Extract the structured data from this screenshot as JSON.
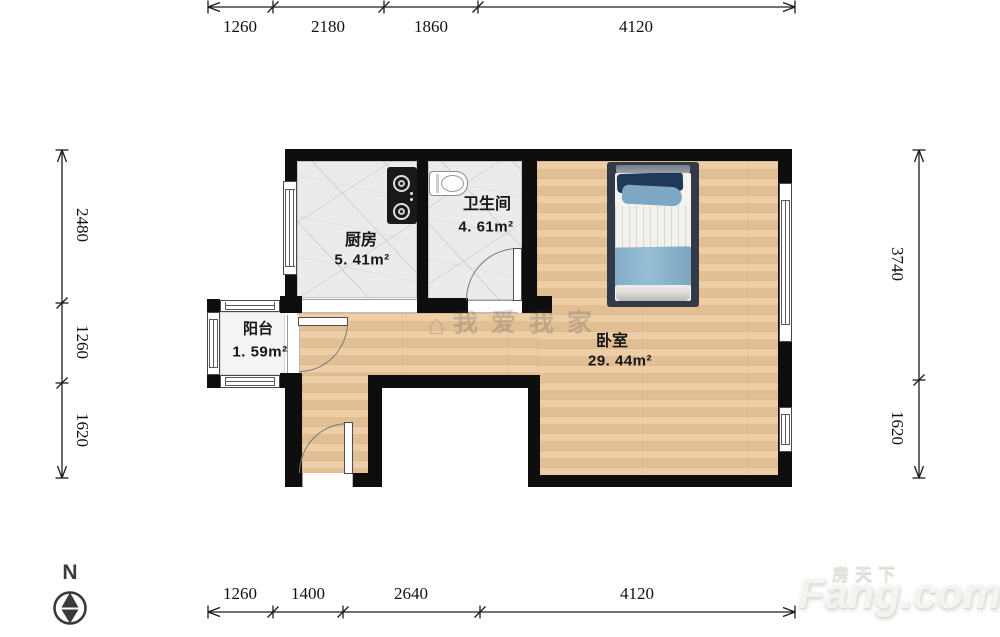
{
  "rooms": {
    "kitchen": {
      "name": "厨房",
      "area": "5. 41m²"
    },
    "bathroom": {
      "name": "卫生间",
      "area": "4. 61m²"
    },
    "balcony": {
      "name": "阳台",
      "area": "1. 59m²"
    },
    "bedroom": {
      "name": "卧室",
      "area": "29. 44m²"
    }
  },
  "dimensions": {
    "top": [
      "1260",
      "2180",
      "1860",
      "4120"
    ],
    "bottom": [
      "1260",
      "1400",
      "2640",
      "4120"
    ],
    "left": [
      "2480",
      "1260",
      "1620"
    ],
    "right": [
      "3740",
      "1620"
    ]
  },
  "compass": {
    "label": "N"
  },
  "watermarks": {
    "center_icon": "⌂",
    "center": "我爱我家",
    "brand_cn": "房天下",
    "brand_en": "Fang.com"
  },
  "colors": {
    "wall": "#0e0e0e",
    "wood_floor": "#ecc79b",
    "tile_floor": "#ebebea",
    "bed_frame": "#323947",
    "pillow_navy": "#20395a",
    "blanket_blue": "#8bb3cc",
    "dimension_text": "#111111"
  }
}
